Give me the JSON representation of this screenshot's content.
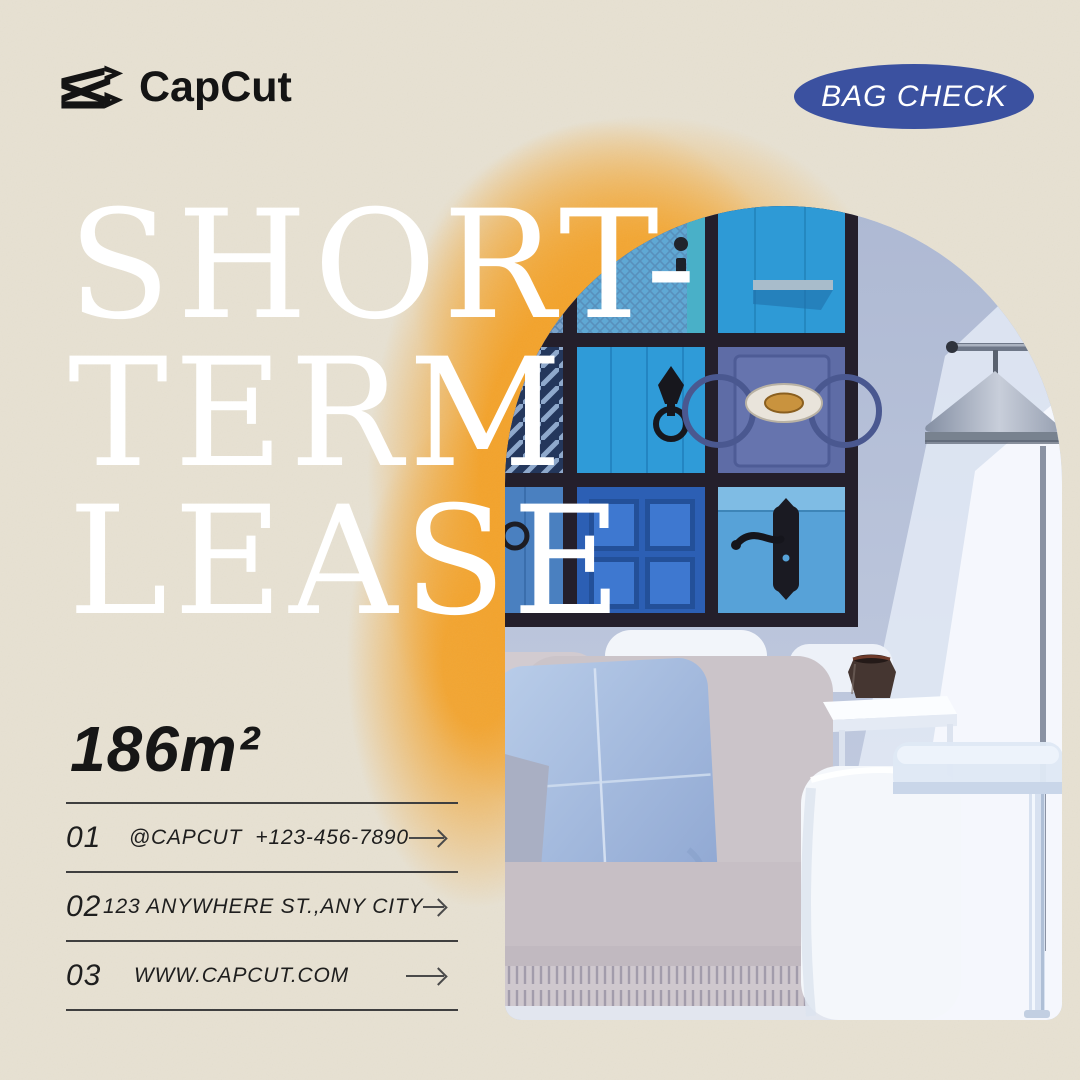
{
  "brand": {
    "name": "CapCut"
  },
  "badge": {
    "label": "BAG CHECK",
    "bg_color": "#3B51A0",
    "text_color": "#FFFFFF"
  },
  "headline": {
    "lines": [
      "SHORT-",
      "TERM",
      "LEASE"
    ],
    "color": "#FFFFFF"
  },
  "area_label": "186m²",
  "contact": {
    "rows": [
      {
        "num": "01",
        "label": "@CAPCUT  +123-456-7890"
      },
      {
        "num": "02",
        "label": "123 ANYWHERE ST.,ANY CITY"
      },
      {
        "num": "03",
        "label": "WWW.CAPCUT.COM"
      }
    ]
  },
  "icons": {
    "capcut_logo": "capcut-clapper-icon",
    "arrow_right": "thin-right-arrow"
  },
  "colors": {
    "background": "#E7E1D2",
    "accent_orange": "#F3A32C",
    "badge_blue": "#3B51A0",
    "ink": "#1B1B1B",
    "rule": "#3F3F3F",
    "headline_white": "#FFFFFF"
  },
  "photo": {
    "alt": "Arched photo of a living room with a gallery wall of blue door pictures, a grey cone floor lamp, a white sofa with a light blue pillow and fringed throw, and white side tables"
  }
}
